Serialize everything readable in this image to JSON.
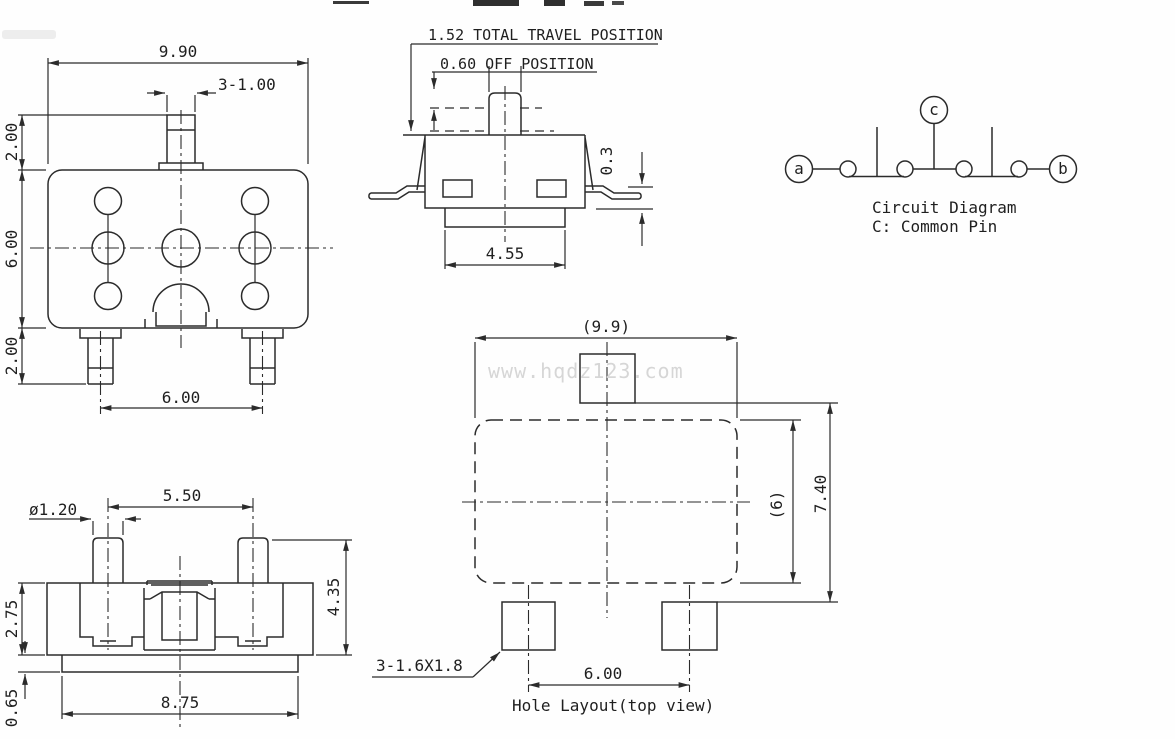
{
  "drawing": {
    "watermark": "www.hqdz123.com",
    "top_view": {
      "dim_width": "9.90",
      "dim_stem": "3-1.00",
      "dim_stem_height": "2.00",
      "dim_body_height": "6.00",
      "dim_pin_height": "2.00",
      "dim_pin_span": "6.00"
    },
    "side_view": {
      "note_total_travel": "1.52 TOTAL TRAVEL POSITION",
      "note_off_position": "0.60 OFF POSITION",
      "dim_lead": "0.3",
      "dim_base_width": "4.55"
    },
    "circuit": {
      "terminal_a": "a",
      "terminal_b": "b",
      "terminal_c": "c",
      "title": "Circuit Diagram",
      "subtitle": "C: Common Pin"
    },
    "front_view": {
      "dim_post_dia": "ø1.20",
      "dim_post_span": "5.50",
      "dim_body_height": "2.75",
      "dim_total_height": "4.35",
      "dim_base_height": "0.65",
      "dim_base_width": "8.75"
    },
    "hole_layout": {
      "dim_width_ref": "(9.9)",
      "dim_height_ref": "(6)",
      "dim_total_height": "7.40",
      "dim_hole_span": "6.00",
      "note_hole_size": "3-1.6X1.8",
      "caption": "Hole Layout(top view)"
    }
  },
  "colors": {
    "line": "#2b2b2b",
    "text": "#1f1f1f",
    "watermark": "#d6d6d6",
    "background": "#fefefe"
  }
}
